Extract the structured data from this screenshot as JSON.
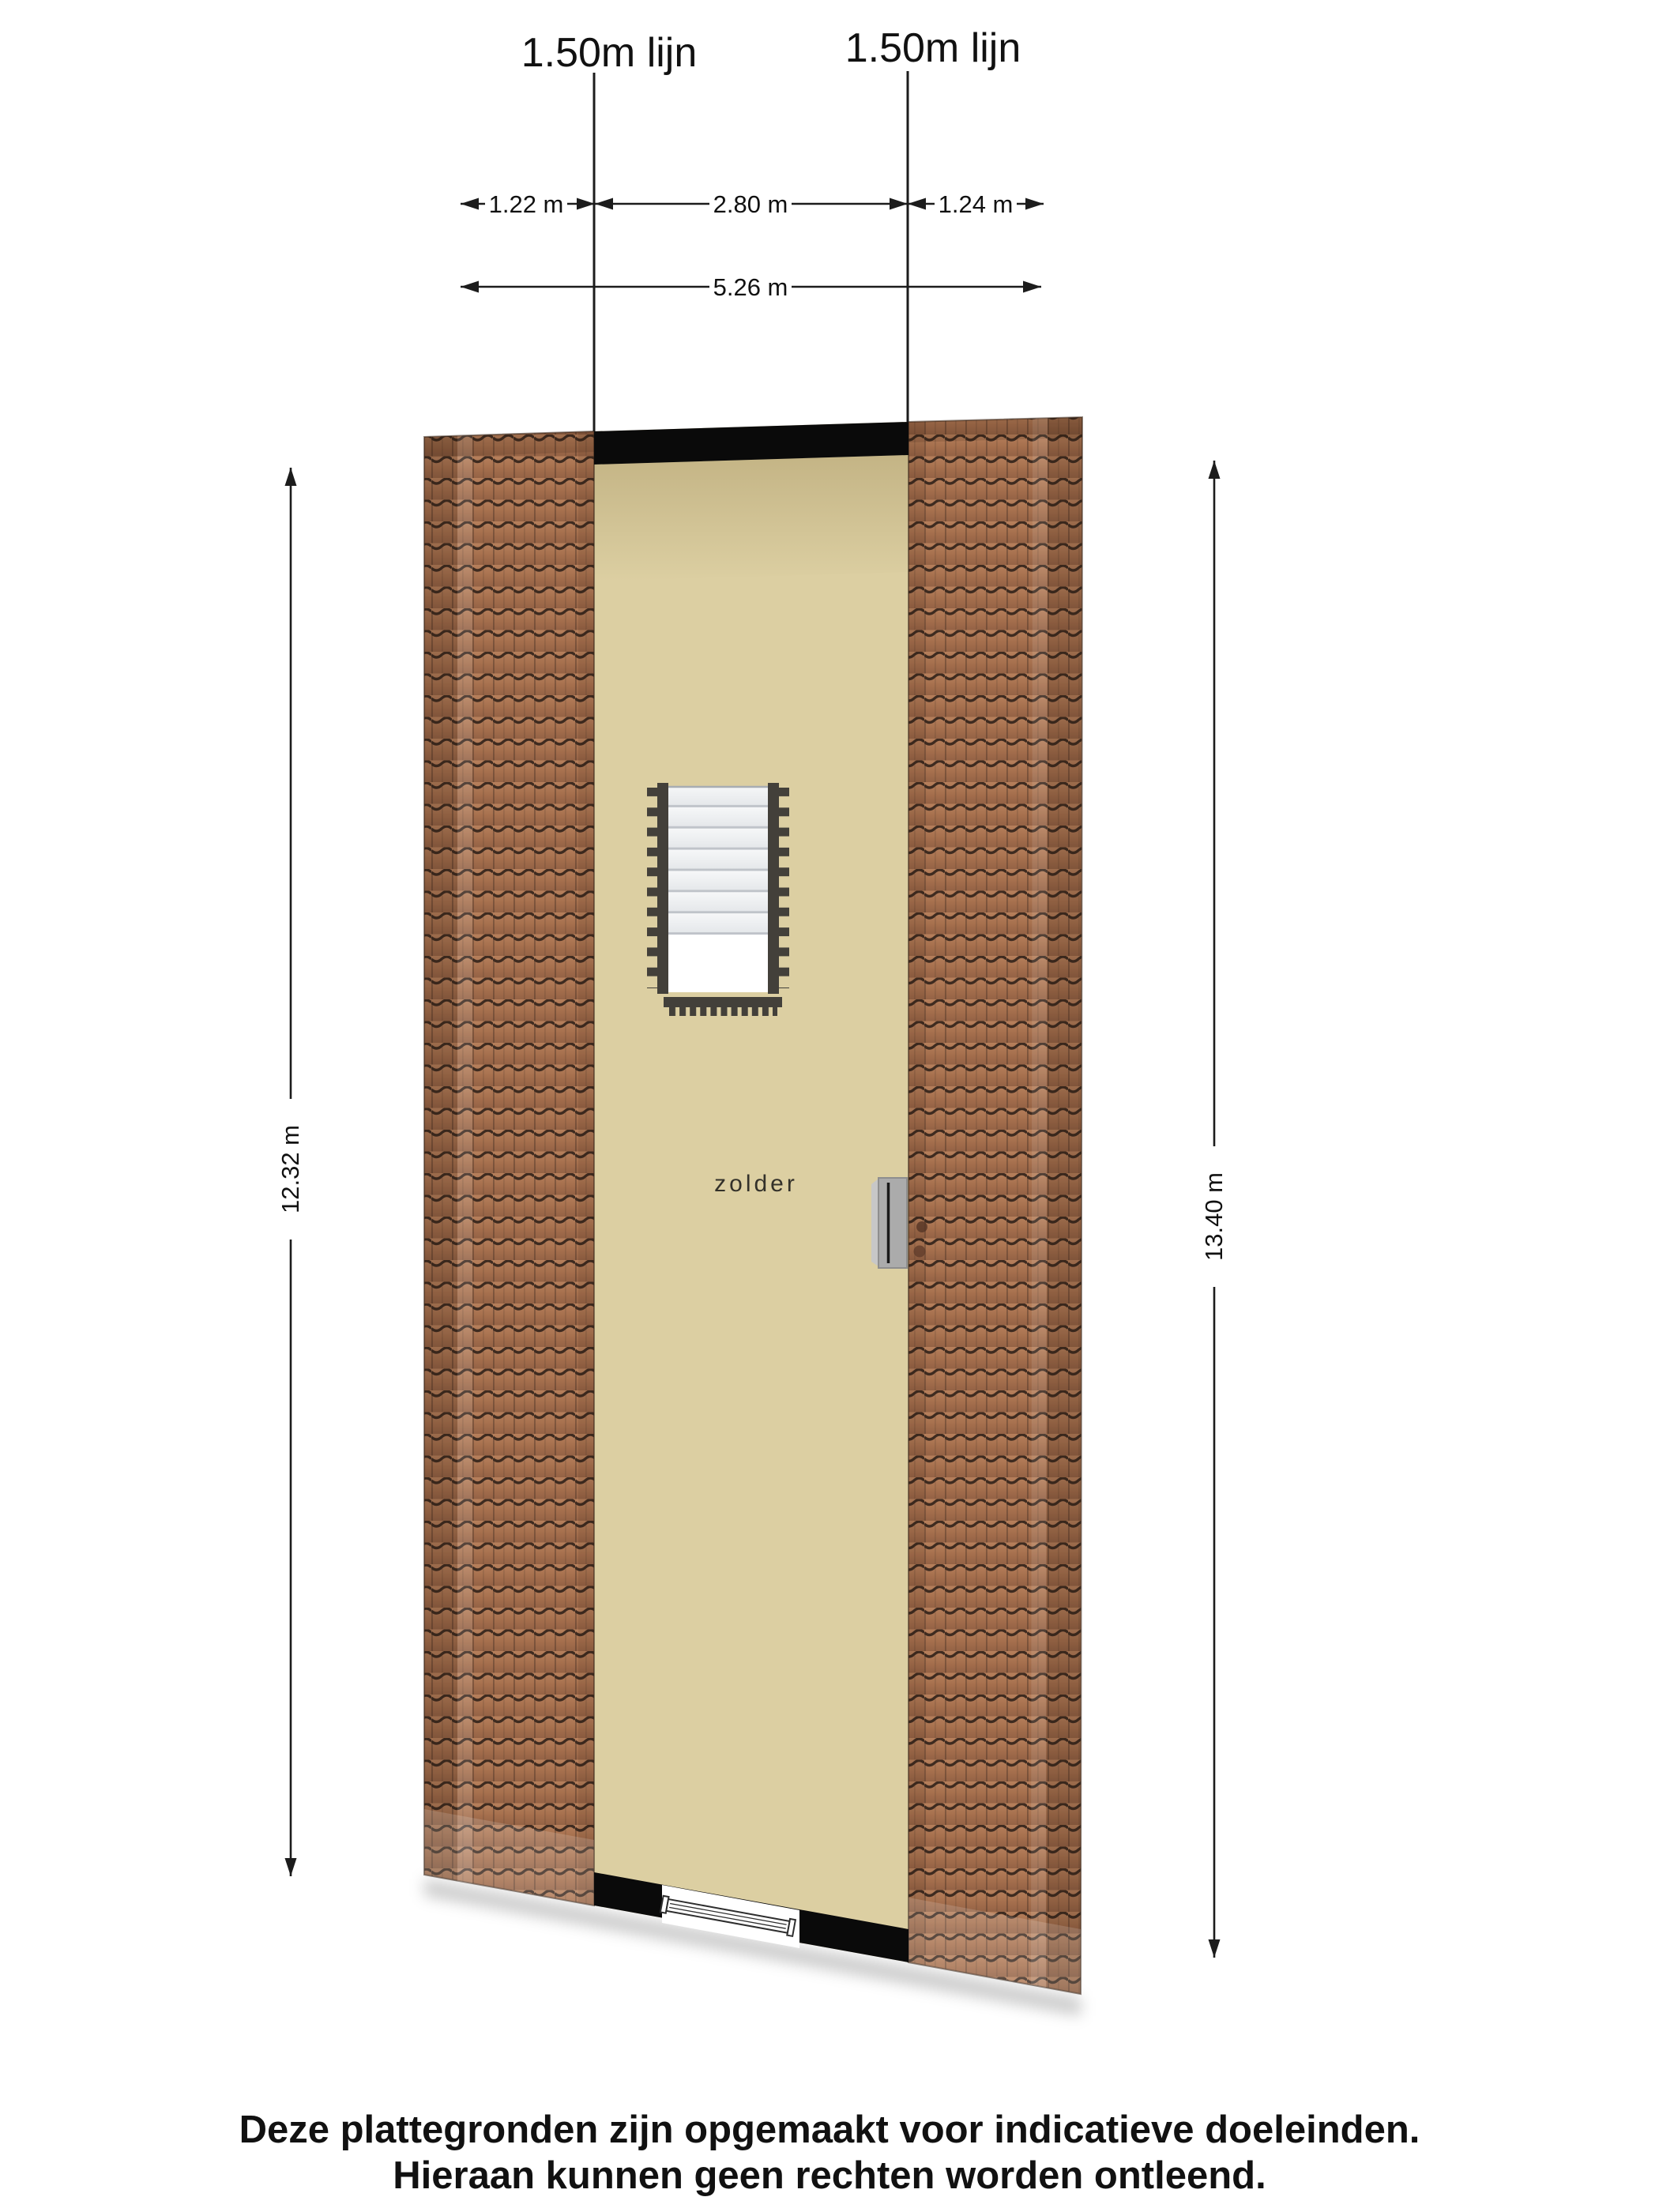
{
  "labels": {
    "line_label_left": "1.50m lijn",
    "line_label_right": "1.50m lijn"
  },
  "dimensions": {
    "width_segments": [
      {
        "label": "1.22 m"
      },
      {
        "label": "2.80 m"
      },
      {
        "label": "1.24 m"
      }
    ],
    "width_total": "5.26 m",
    "height_left": "12.32 m",
    "height_right": "13.40 m"
  },
  "room": {
    "label": "zolder"
  },
  "footer": {
    "line1": "Deze plattegronden zijn opgemaakt voor indicatieve doeleinden.",
    "line2": "Hieraan kunnen geen rechten worden ontleend."
  },
  "colors": {
    "background": "#ffffff",
    "floor": "#dccfa2",
    "wall": "#0a0a0a",
    "tile_base": "#a56f4d",
    "tile_groove": "#3e2b20",
    "stair_rail": "#43403a",
    "stair_tread": "#eef0f2",
    "stair_opening": "#ffffff",
    "roof_window": "#ababab",
    "dimension_line": "#1c1c1c",
    "text": "#111111"
  }
}
